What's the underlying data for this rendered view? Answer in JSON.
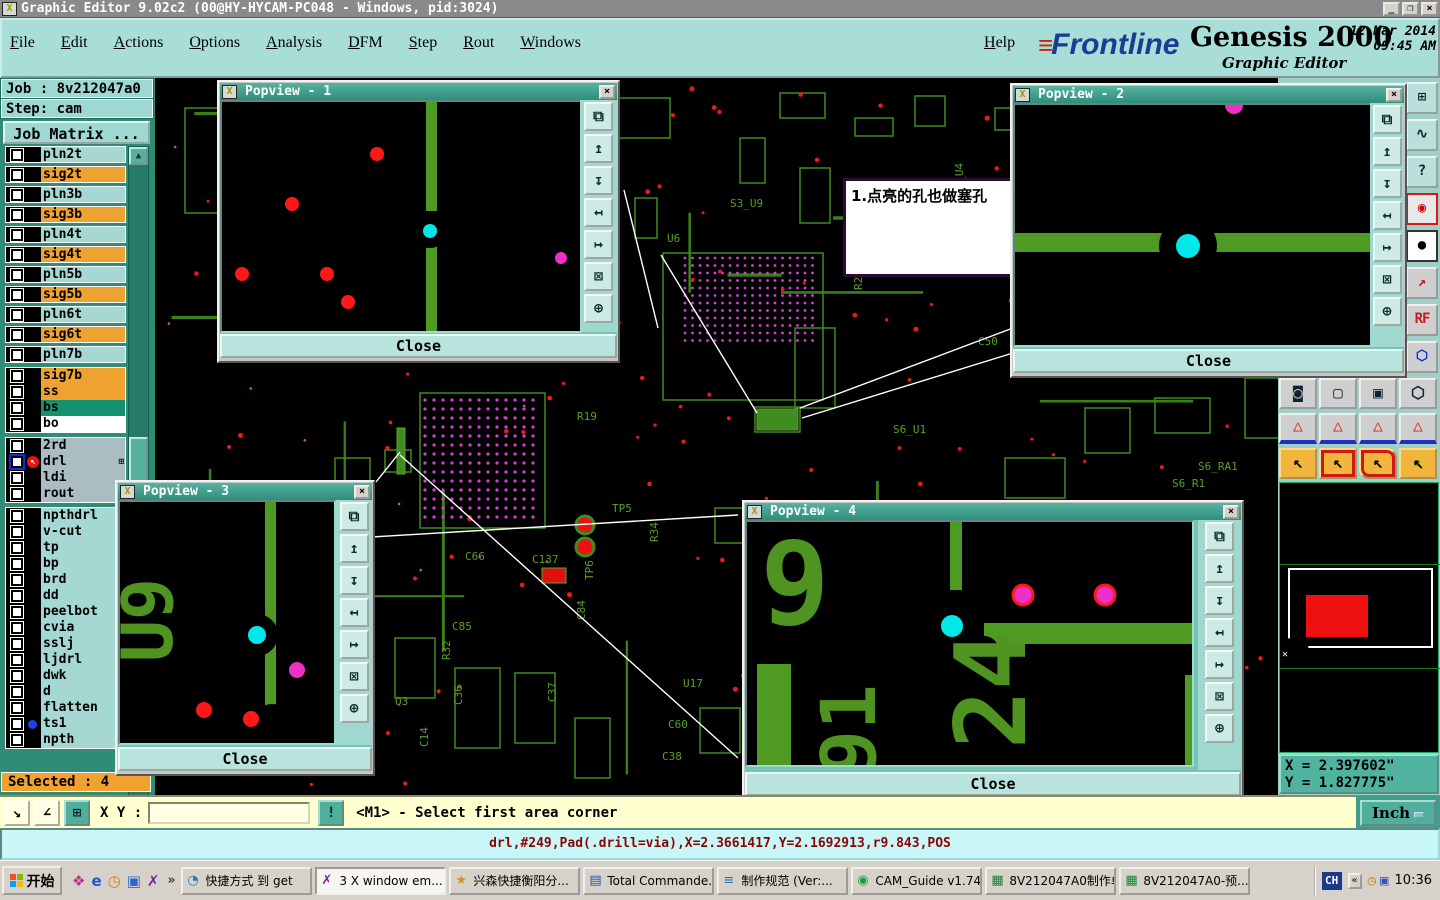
{
  "window": {
    "title": "Graphic Editor 9.02c2 (00@HY-HYCAM-PC048 - Windows, pid:3024)",
    "icon_glyph": "X",
    "controls": [
      {
        "glyph": "_",
        "name": "minimize-button"
      },
      {
        "glyph": "❐",
        "name": "restore-button"
      },
      {
        "glyph": "×",
        "name": "close-button"
      }
    ]
  },
  "menubar": {
    "items": [
      "File",
      "Edit",
      "Actions",
      "Options",
      "Analysis",
      "DFM",
      "Step",
      "Rout",
      "Windows"
    ],
    "help": "Help"
  },
  "branding": {
    "logo_lines": "≡",
    "logo_text": "Frontline",
    "product": "Genesis 2000",
    "datetime": "12 Mar 2014\n09:45 AM",
    "subtitle": "Graphic Editor"
  },
  "sidebar": {
    "job_label": "Job : 8v212047a0",
    "step_label": "Step: cam",
    "job_matrix_button": "Job Matrix ...",
    "selected_label": "Selected : 4",
    "layer_groups": [
      {
        "spread": true,
        "rows": [
          {
            "n": "pln2t",
            "c": "t"
          },
          {
            "n": "sig2t",
            "c": "o"
          },
          {
            "n": "pln3b",
            "c": "t"
          },
          {
            "n": "sig3b",
            "c": "o"
          },
          {
            "n": "pln4t",
            "c": "t"
          },
          {
            "n": "sig4t",
            "c": "o"
          },
          {
            "n": "pln5b",
            "c": "t"
          },
          {
            "n": "sig5b",
            "c": "o"
          },
          {
            "n": "pln6t",
            "c": "t"
          },
          {
            "n": "sig6t",
            "c": "o"
          },
          {
            "n": "pln7b",
            "c": "t"
          }
        ]
      },
      {
        "spread": false,
        "rows": [
          {
            "n": "sig7b",
            "c": "o"
          },
          {
            "n": "ss",
            "c": "o"
          },
          {
            "n": "bs",
            "c": "g"
          },
          {
            "n": "bo",
            "c": "w"
          }
        ]
      },
      {
        "spread": false,
        "rows": [
          {
            "n": "2rd",
            "c": "gr"
          },
          {
            "n": "drl",
            "c": "gr",
            "active": true,
            "grid": true
          },
          {
            "n": "ldi",
            "c": "gr"
          },
          {
            "n": "rout",
            "c": "gr"
          }
        ]
      },
      {
        "spread": false,
        "rows": [
          {
            "n": "npthdrl",
            "c": "t"
          },
          {
            "n": "v-cut",
            "c": "t"
          },
          {
            "n": "tp",
            "c": "t"
          },
          {
            "n": "bp",
            "c": "t"
          },
          {
            "n": "brd",
            "c": "t"
          },
          {
            "n": "dd",
            "c": "t"
          },
          {
            "n": "peelbot",
            "c": "t"
          },
          {
            "n": "cvia",
            "c": "t"
          },
          {
            "n": "sslj",
            "c": "t"
          },
          {
            "n": "ljdrl",
            "c": "t"
          },
          {
            "n": "dwk",
            "c": "t"
          },
          {
            "n": "d",
            "c": "t"
          },
          {
            "n": "flatten",
            "c": "t"
          },
          {
            "n": "ts1",
            "c": "t",
            "dot": true
          },
          {
            "n": "npth",
            "c": "t"
          }
        ]
      }
    ]
  },
  "annotation": {
    "text": "1.点亮的孔也做塞孔"
  },
  "popview_tool_icons": [
    {
      "g": "⧉",
      "name": "clone-view-icon"
    },
    {
      "g": "↥",
      "name": "pan-up-icon"
    },
    {
      "g": "↧",
      "name": "pan-down-icon"
    },
    {
      "g": "↤",
      "name": "pan-left-icon"
    },
    {
      "g": "↦",
      "name": "pan-right-icon"
    },
    {
      "g": "⊠",
      "name": "zoom-fit-icon"
    },
    {
      "g": "⊕",
      "name": "pan-center-icon"
    }
  ],
  "popviews": [
    {
      "title": "Popview - 1",
      "close_label": "Close",
      "close_glyph": "×",
      "scene": {
        "traces": [
          [
            204,
            0,
            11,
            109
          ],
          [
            204,
            142,
            11,
            91
          ]
        ],
        "cuts": [
          [
            208,
            129,
            17
          ]
        ],
        "texts": [],
        "dots": [
          [
            208,
            129,
            7,
            "cyan"
          ],
          [
            155,
            52,
            7,
            "red"
          ],
          [
            70,
            102,
            7,
            "red"
          ],
          [
            20,
            172,
            7,
            "red"
          ],
          [
            105,
            172,
            7,
            "red"
          ],
          [
            126,
            200,
            7,
            "red"
          ],
          [
            339,
            156,
            6,
            "mag"
          ]
        ]
      }
    },
    {
      "title": "Popview - 2",
      "close_label": "Close",
      "close_glyph": "×",
      "scene": {
        "traces": [
          [
            0,
            128,
            359,
            19
          ]
        ],
        "cuts": [
          [
            173,
            141,
            29
          ]
        ],
        "texts": [],
        "dots": [
          [
            219,
            0,
            9,
            "mag"
          ],
          [
            173,
            141,
            12,
            "cyan"
          ]
        ]
      }
    },
    {
      "title": "Popview - 3",
      "close_label": "Close",
      "close_glyph": "×",
      "scene": {
        "traces": [
          [
            145,
            0,
            11,
            245
          ]
        ],
        "cuts": [
          [
            137,
            133,
            21
          ],
          [
            152,
            222,
            20
          ]
        ],
        "texts": [
          [
            "U9",
            52,
            118,
            -90,
            70
          ]
        ],
        "dots": [
          [
            137,
            133,
            9,
            "cyan"
          ],
          [
            177,
            168,
            8,
            "mag"
          ],
          [
            84,
            208,
            8,
            "red"
          ],
          [
            131,
            217,
            8,
            "red"
          ]
        ]
      }
    },
    {
      "title": "Popview - 4",
      "close_label": "Close",
      "close_glyph": "×",
      "scene": {
        "traces": [
          [
            203,
            0,
            12,
            68
          ],
          [
            237,
            101,
            212,
            21
          ],
          [
            10,
            142,
            34,
            105
          ],
          [
            438,
            153,
            11,
            94
          ]
        ],
        "cuts": [
          [
            205,
            104,
            18
          ],
          [
            237,
            129,
            15
          ]
        ],
        "texts": [
          [
            "9",
            48,
            102,
            0,
            115
          ],
          [
            "24",
            278,
            168,
            -90,
            98
          ],
          [
            "91",
            128,
            208,
            -90,
            76
          ]
        ],
        "dots": [
          [
            205,
            104,
            11,
            "cyan"
          ],
          [
            276,
            73,
            10,
            "mag",
            "red"
          ],
          [
            358,
            73,
            10,
            "mag",
            "red"
          ]
        ]
      }
    }
  ],
  "board": {
    "labels": [
      [
        "U10",
        325,
        82,
        -90
      ],
      [
        "S3_U9",
        575,
        129,
        0
      ],
      [
        "U6",
        512,
        164,
        0
      ],
      [
        "S3_Q2",
        740,
        142,
        0
      ],
      [
        "C48",
        807,
        132,
        0
      ],
      [
        "U8",
        788,
        144,
        -90
      ],
      [
        "R28",
        707,
        212,
        -90
      ],
      [
        "C50",
        823,
        267,
        0
      ],
      [
        "R19",
        422,
        342,
        0
      ],
      [
        "S6_U1",
        738,
        355,
        0
      ],
      [
        "S6_RA1",
        1043,
        392,
        0
      ],
      [
        "S6_R1",
        1017,
        409,
        0
      ],
      [
        "TP5",
        457,
        434,
        0
      ],
      [
        "TP6",
        438,
        502,
        -90
      ],
      [
        "R34",
        503,
        464,
        -90
      ],
      [
        "C66",
        310,
        482,
        0
      ],
      [
        "C137",
        377,
        485,
        0
      ],
      [
        "C85",
        297,
        552,
        0
      ],
      [
        "R32",
        295,
        582,
        -90
      ],
      [
        "C84",
        430,
        542,
        -90
      ],
      [
        "U17",
        528,
        609,
        0
      ],
      [
        "Q3",
        240,
        627,
        0
      ],
      [
        "C36",
        307,
        627,
        -90
      ],
      [
        "C37",
        401,
        624,
        -90
      ],
      [
        "C14",
        273,
        669,
        -90
      ],
      [
        "C60",
        513,
        650,
        0
      ],
      [
        "C38",
        507,
        682,
        0
      ],
      [
        "S3_U4",
        808,
        118,
        -90
      ]
    ],
    "outline_rects": [
      [
        30,
        30,
        52,
        105
      ],
      [
        508,
        175,
        160,
        147
      ],
      [
        265,
        315,
        125,
        135
      ],
      [
        455,
        20,
        60,
        40
      ],
      [
        625,
        15,
        45,
        25
      ],
      [
        700,
        40,
        38,
        18
      ],
      [
        760,
        18,
        30,
        30
      ],
      [
        840,
        30,
        40,
        22
      ],
      [
        900,
        12,
        35,
        35
      ],
      [
        585,
        60,
        25,
        45
      ],
      [
        645,
        90,
        30,
        55
      ],
      [
        480,
        120,
        22,
        40
      ],
      [
        700,
        120,
        45,
        30
      ],
      [
        640,
        250,
        40,
        80
      ],
      [
        600,
        329,
        45,
        25
      ],
      [
        230,
        372,
        26,
        22
      ],
      [
        960,
        120,
        35,
        35
      ],
      [
        1010,
        180,
        30,
        30
      ],
      [
        955,
        230,
        25,
        50
      ],
      [
        1060,
        140,
        40,
        28
      ],
      [
        240,
        560,
        40,
        60
      ],
      [
        300,
        590,
        45,
        80
      ],
      [
        360,
        595,
        40,
        70
      ],
      [
        420,
        640,
        35,
        60
      ],
      [
        545,
        630,
        40,
        45
      ],
      [
        680,
        560,
        60,
        60
      ],
      [
        800,
        560,
        40,
        80
      ],
      [
        920,
        560,
        60,
        45
      ],
      [
        1000,
        540,
        40,
        70
      ],
      [
        850,
        380,
        60,
        40
      ],
      [
        930,
        330,
        45,
        45
      ],
      [
        1000,
        320,
        55,
        35
      ],
      [
        1090,
        300,
        40,
        60
      ],
      [
        180,
        380,
        35,
        55
      ],
      [
        560,
        430,
        40,
        35
      ]
    ],
    "filled_rects": [
      [
        242,
        350,
        8,
        46
      ],
      [
        387,
        490,
        24,
        15
      ],
      [
        602,
        331,
        41,
        21
      ],
      [
        755,
        640,
        40,
        14
      ],
      [
        160,
        520,
        30,
        12
      ]
    ],
    "pads": [
      [
        430,
        447,
        9
      ],
      [
        430,
        469,
        9
      ]
    ],
    "bga_grids": [
      {
        "x": 270,
        "y": 322,
        "cols": 13,
        "rows": 14,
        "step": 9,
        "r": 1.6
      },
      {
        "x": 530,
        "y": 180,
        "cols": 18,
        "rows": 12,
        "step": 7.5,
        "r": 1.4
      }
    ],
    "leader_lines": [
      [
        469,
        112,
        503,
        250
      ],
      [
        506,
        177,
        602,
        335
      ],
      [
        645,
        330,
        858,
        250
      ],
      [
        647,
        340,
        858,
        275
      ],
      [
        245,
        377,
        583,
        680
      ],
      [
        0,
        472,
        583,
        437
      ],
      [
        245,
        374,
        221,
        404
      ]
    ]
  },
  "right_panel": {
    "x_readout": "X = 2.397602\"\nY = 1.827775\"",
    "column_tools": [
      {
        "g": "⊞",
        "name": "tile-windows-icon",
        "cls": ""
      },
      {
        "g": "∿",
        "name": "serpentine-route-icon",
        "cls": ""
      },
      {
        "g": "?",
        "name": "help-icon",
        "cls": ""
      },
      {
        "g": "◉",
        "name": "status-lights-icon",
        "cls": "red-frame"
      },
      {
        "g": "●",
        "name": "pad-display-icon",
        "cls": "white-bg"
      },
      {
        "g": "↗",
        "name": "measure-point-icon",
        "cls": "dot-red"
      },
      {
        "g": "RF",
        "name": "rf-mode-icon",
        "cls": "rf"
      },
      {
        "g": "⬡",
        "name": "shape-tools-icon",
        "cls": "blue"
      }
    ],
    "grid_rows": [
      {
        "y": 300,
        "items": [
          {
            "g": "◙",
            "name": "pad-mode-icon",
            "cls": ""
          },
          {
            "g": "▢",
            "name": "outline-mode-icon",
            "cls": ""
          },
          {
            "g": "▣",
            "name": "fill-mode-icon",
            "cls": ""
          },
          {
            "g": "⬡",
            "name": "poly-mode-icon",
            "cls": "blue"
          }
        ]
      },
      {
        "y": 335,
        "items": [
          {
            "g": "△",
            "name": "profile-flat-icon",
            "cls": "tri"
          },
          {
            "g": "△",
            "name": "profile-peak-icon",
            "cls": "tri"
          },
          {
            "g": "△",
            "name": "profile-trap-icon",
            "cls": "tri"
          },
          {
            "g": "△",
            "name": "profile-span-icon",
            "cls": "tri"
          }
        ]
      },
      {
        "y": 370,
        "items": [
          {
            "g": "↖",
            "name": "select-single-icon",
            "cls": "sel"
          },
          {
            "g": "↖",
            "name": "select-frame-icon",
            "cls": "sel rbox"
          },
          {
            "g": "↖",
            "name": "select-poly-icon",
            "cls": "sel rpoly"
          },
          {
            "g": "↖",
            "name": "select-net-icon",
            "cls": "sel rpath"
          }
        ]
      }
    ]
  },
  "bottom_bar": {
    "tools": [
      {
        "g": "↘",
        "name": "measure-distance-icon",
        "teal": false
      },
      {
        "g": "∠",
        "name": "measure-angle-icon",
        "teal": false
      },
      {
        "g": "⊞",
        "name": "grid-toggle-icon",
        "teal": true
      }
    ],
    "xy_label": "X Y :",
    "input_value": "",
    "bang_glyph": "!",
    "prompt": "<M1> - Select first area corner",
    "unit_button": "Inch"
  },
  "status_bar": {
    "text": "drl,#249,Pad(.drill=via),X=2.3661417,Y=2.1692913,r9.843,POS"
  },
  "taskbar": {
    "start": "开始",
    "quick_launch": [
      {
        "g": "❖",
        "color": "#c03090",
        "name": "app-shortcut-icon"
      },
      {
        "g": "e",
        "color": "#2255cc",
        "name": "ie-icon"
      },
      {
        "g": "◷",
        "color": "#e08000",
        "name": "scheduler-icon"
      },
      {
        "g": "▣",
        "color": "#3366cc",
        "name": "app-icon"
      },
      {
        "g": "✗",
        "color": "#8020a0",
        "name": "xserver-icon"
      }
    ],
    "chevron": "»",
    "buttons": [
      {
        "label": "快捷方式 到 get",
        "g": "◔",
        "color": "#1a7ac0",
        "active": false,
        "name": "task-shortcut-get"
      },
      {
        "label": "3 X window em...",
        "g": "✗",
        "color": "#8020a0",
        "active": true,
        "caret": "▾",
        "name": "task-xwindow-group"
      },
      {
        "label": "兴森快捷衡阳分...",
        "g": "★",
        "color": "#d89018",
        "active": false,
        "name": "task-xingsen"
      },
      {
        "label": "Total Commande...",
        "g": "▤",
        "color": "#2050c0",
        "active": false,
        "name": "task-total-commander"
      },
      {
        "label": "制作规范 (Ver:...",
        "g": "≡",
        "color": "#3a70b8",
        "active": false,
        "name": "task-spec-doc"
      },
      {
        "label": "CAM_Guide v1.74",
        "g": "◉",
        "color": "#18a038",
        "active": false,
        "name": "task-cam-guide"
      },
      {
        "label": "8V212047A0制作单",
        "g": "▦",
        "color": "#1e7e34",
        "active": false,
        "name": "task-excel-1"
      },
      {
        "label": "8V212047A0-预...",
        "g": "▦",
        "color": "#1e7e34",
        "active": false,
        "name": "task-excel-2"
      }
    ],
    "tray": {
      "lang": "CH",
      "chevron": "«",
      "icons": [
        {
          "g": "◷",
          "color": "#e08000",
          "name": "clock-tray-icon"
        },
        {
          "g": "▣",
          "color": "#3355bb",
          "name": "app-tray-icon"
        }
      ],
      "time": "10:36"
    }
  }
}
